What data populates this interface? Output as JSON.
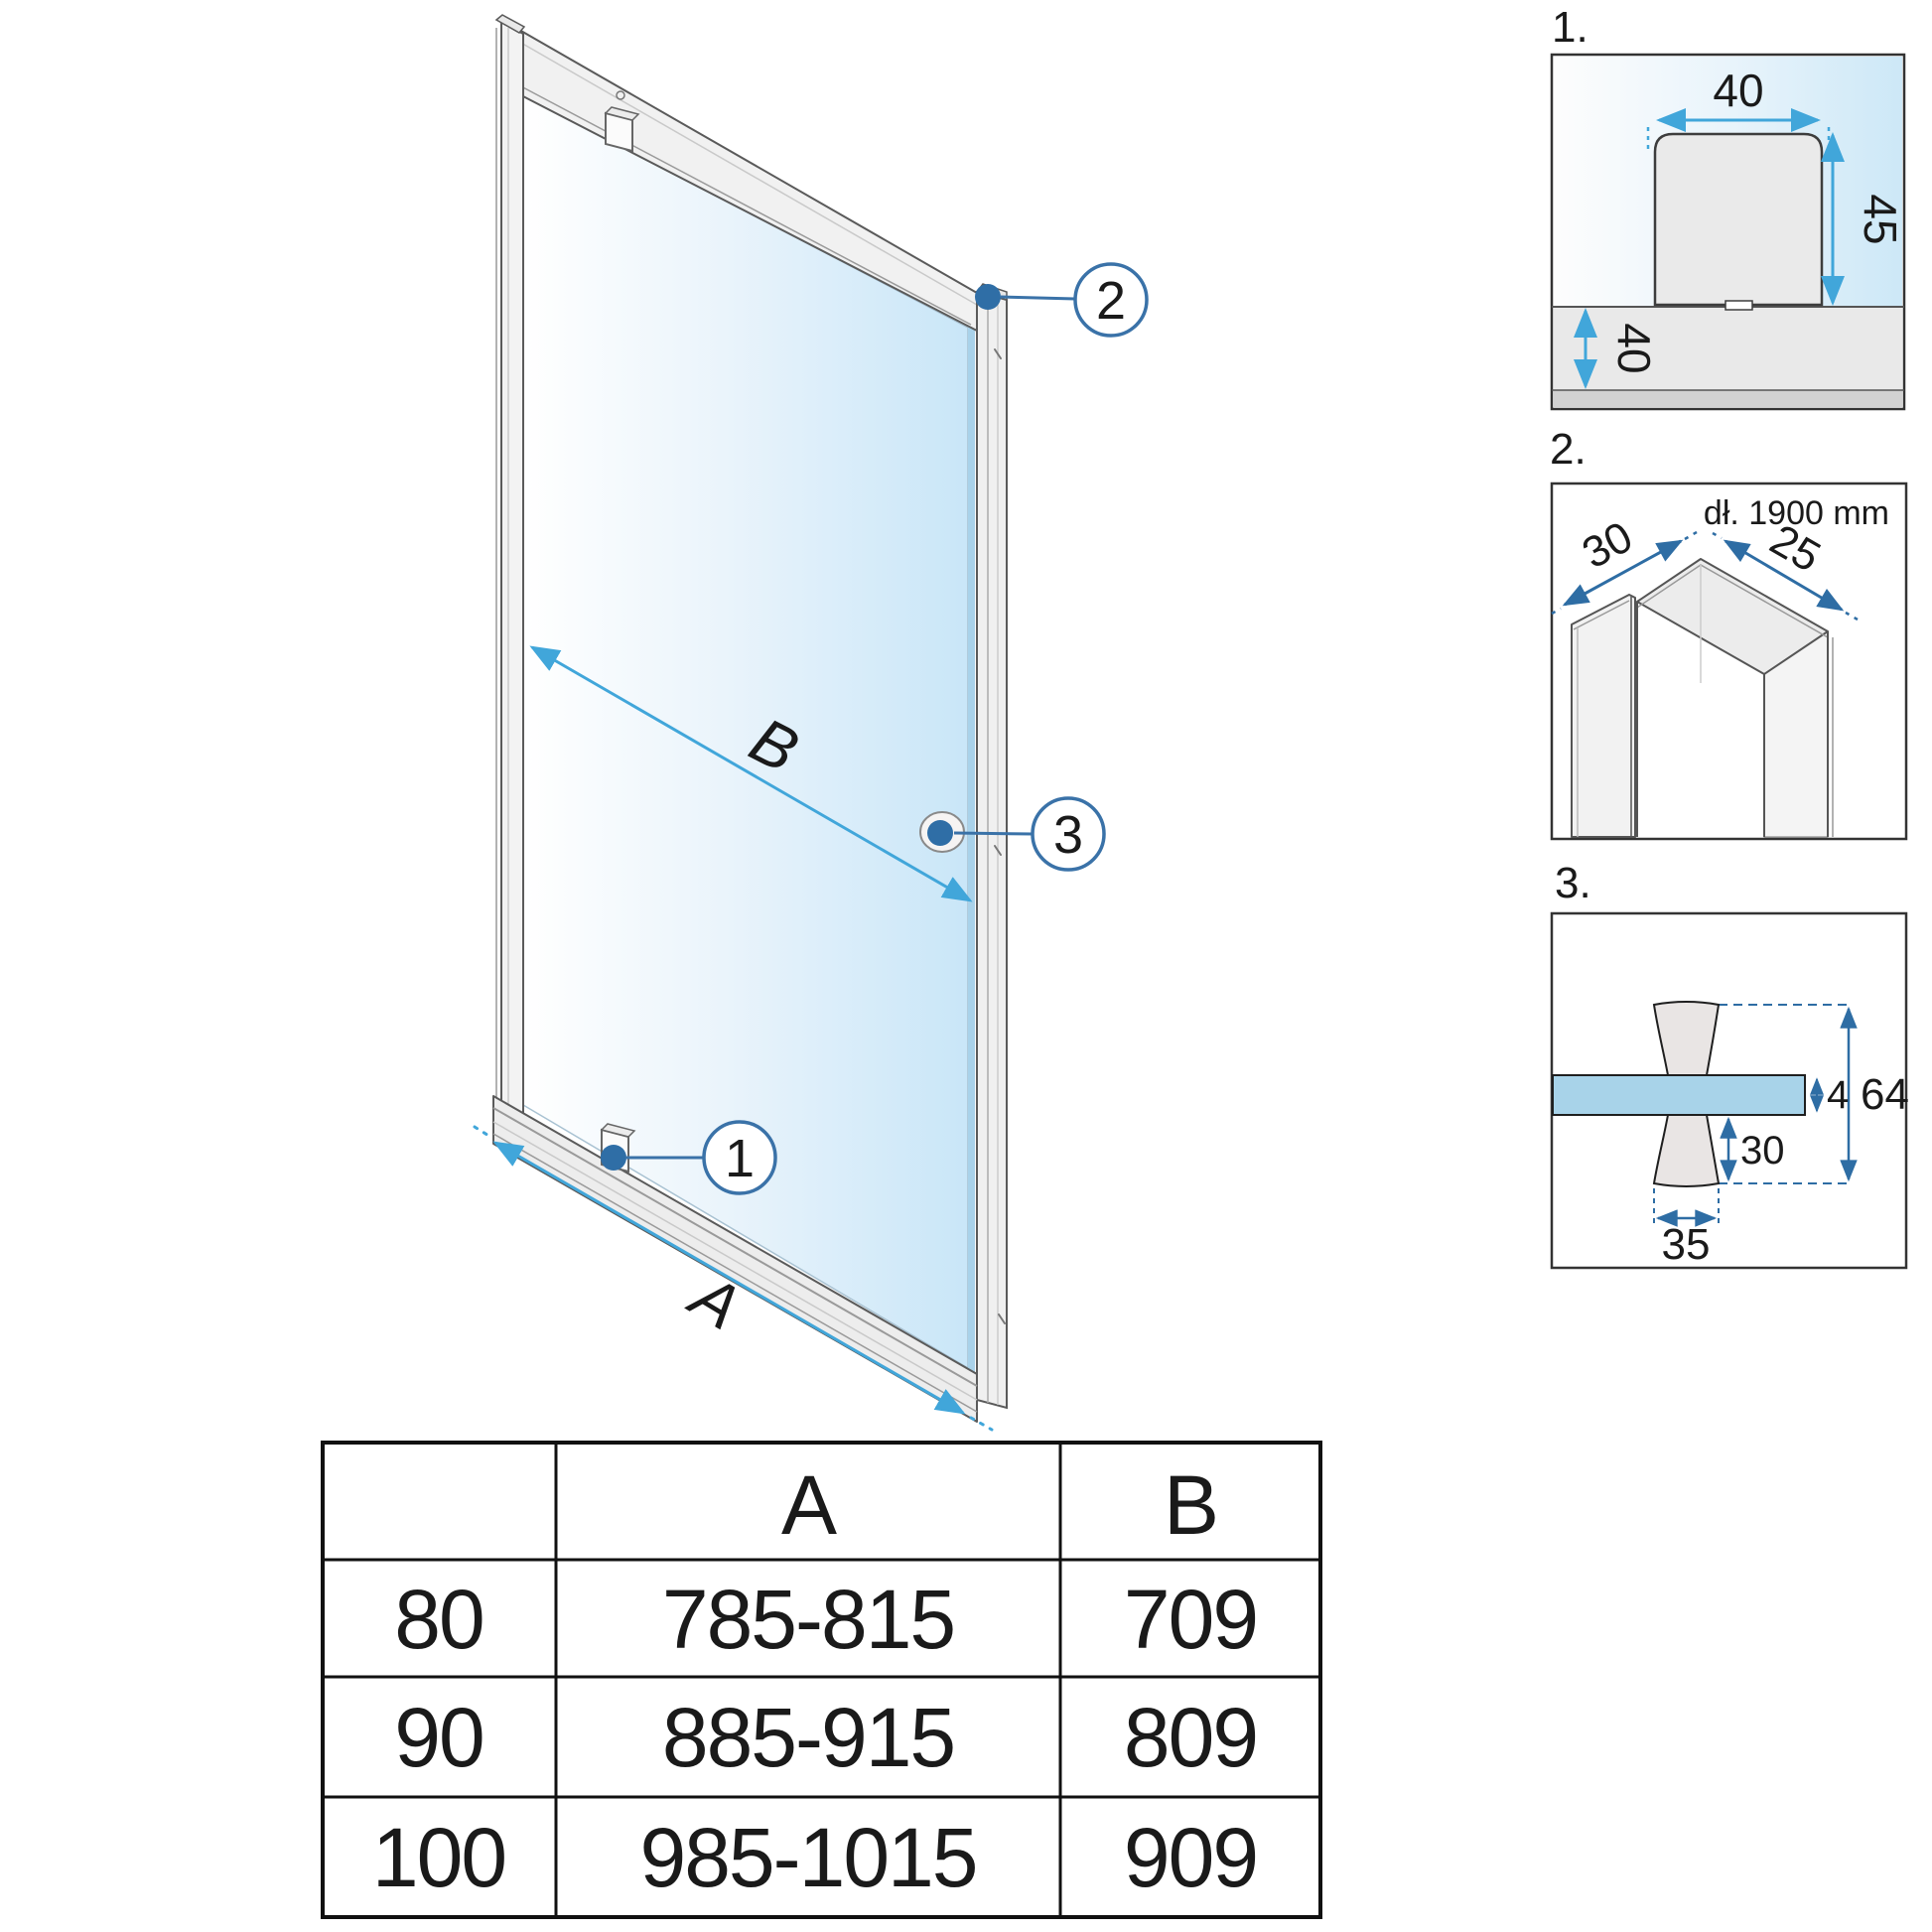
{
  "main": {
    "label_a": "A",
    "label_b": "B",
    "callout_1": "1",
    "callout_2": "2",
    "callout_3": "3"
  },
  "detail1": {
    "label": "1.",
    "dim_bracket_width": "40",
    "dim_bracket_height": "45",
    "dim_sill_height": "40"
  },
  "detail2": {
    "label": "2.",
    "length_note": "dł. 1900 mm",
    "dim_left_depth": "30",
    "dim_right_depth": "25"
  },
  "detail3": {
    "label": "3.",
    "dim_glass_thickness": "4",
    "dim_total_height": "64",
    "dim_knob_height": "30",
    "dim_knob_width": "35"
  },
  "table": {
    "col_size": "",
    "col_a": "A",
    "col_b": "B",
    "rows": [
      {
        "size": "80",
        "a": "785-815",
        "b": "709"
      },
      {
        "size": "90",
        "a": "885-915",
        "b": "809"
      },
      {
        "size": "100",
        "a": "985-1015",
        "b": "909"
      }
    ]
  },
  "colors": {
    "arrow_light_blue": "#41a6da",
    "arrow_steel_blue": "#2e6da4",
    "callout_stroke": "#3a72a8",
    "glass_blue": "#c9e6f8",
    "glass_bar_blue": "#a8d3e9",
    "frame_gray": "#f1f1f1",
    "line_dark": "#555555"
  }
}
